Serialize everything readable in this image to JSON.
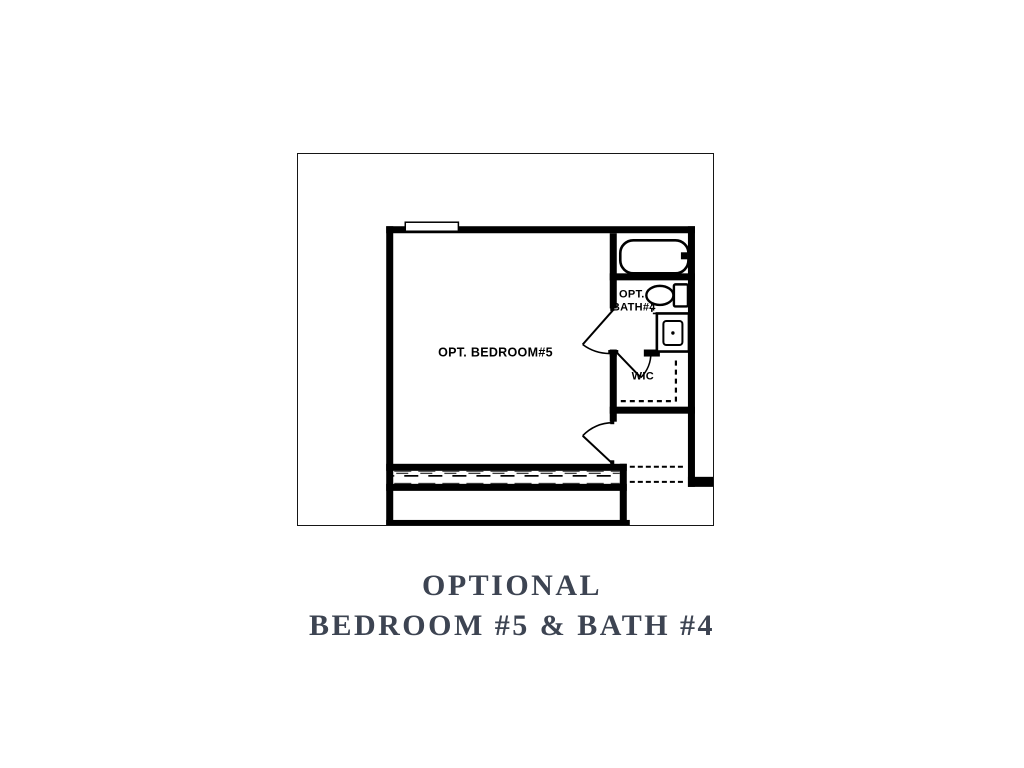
{
  "figure": {
    "plan": {
      "labels": {
        "bedroom": "OPT. BEDROOM#5",
        "bath_line1": "OPT.",
        "bath_line2": "BATH#4",
        "closet": "WIC"
      },
      "fixture_names": [
        "bathtub",
        "toilet",
        "sink-vanity",
        "window-marker"
      ],
      "line_color": "#000000"
    },
    "caption": {
      "line1": "OPTIONAL",
      "line2": "BEDROOM #5 & BATH #4",
      "text_color": "#3d4452"
    }
  }
}
